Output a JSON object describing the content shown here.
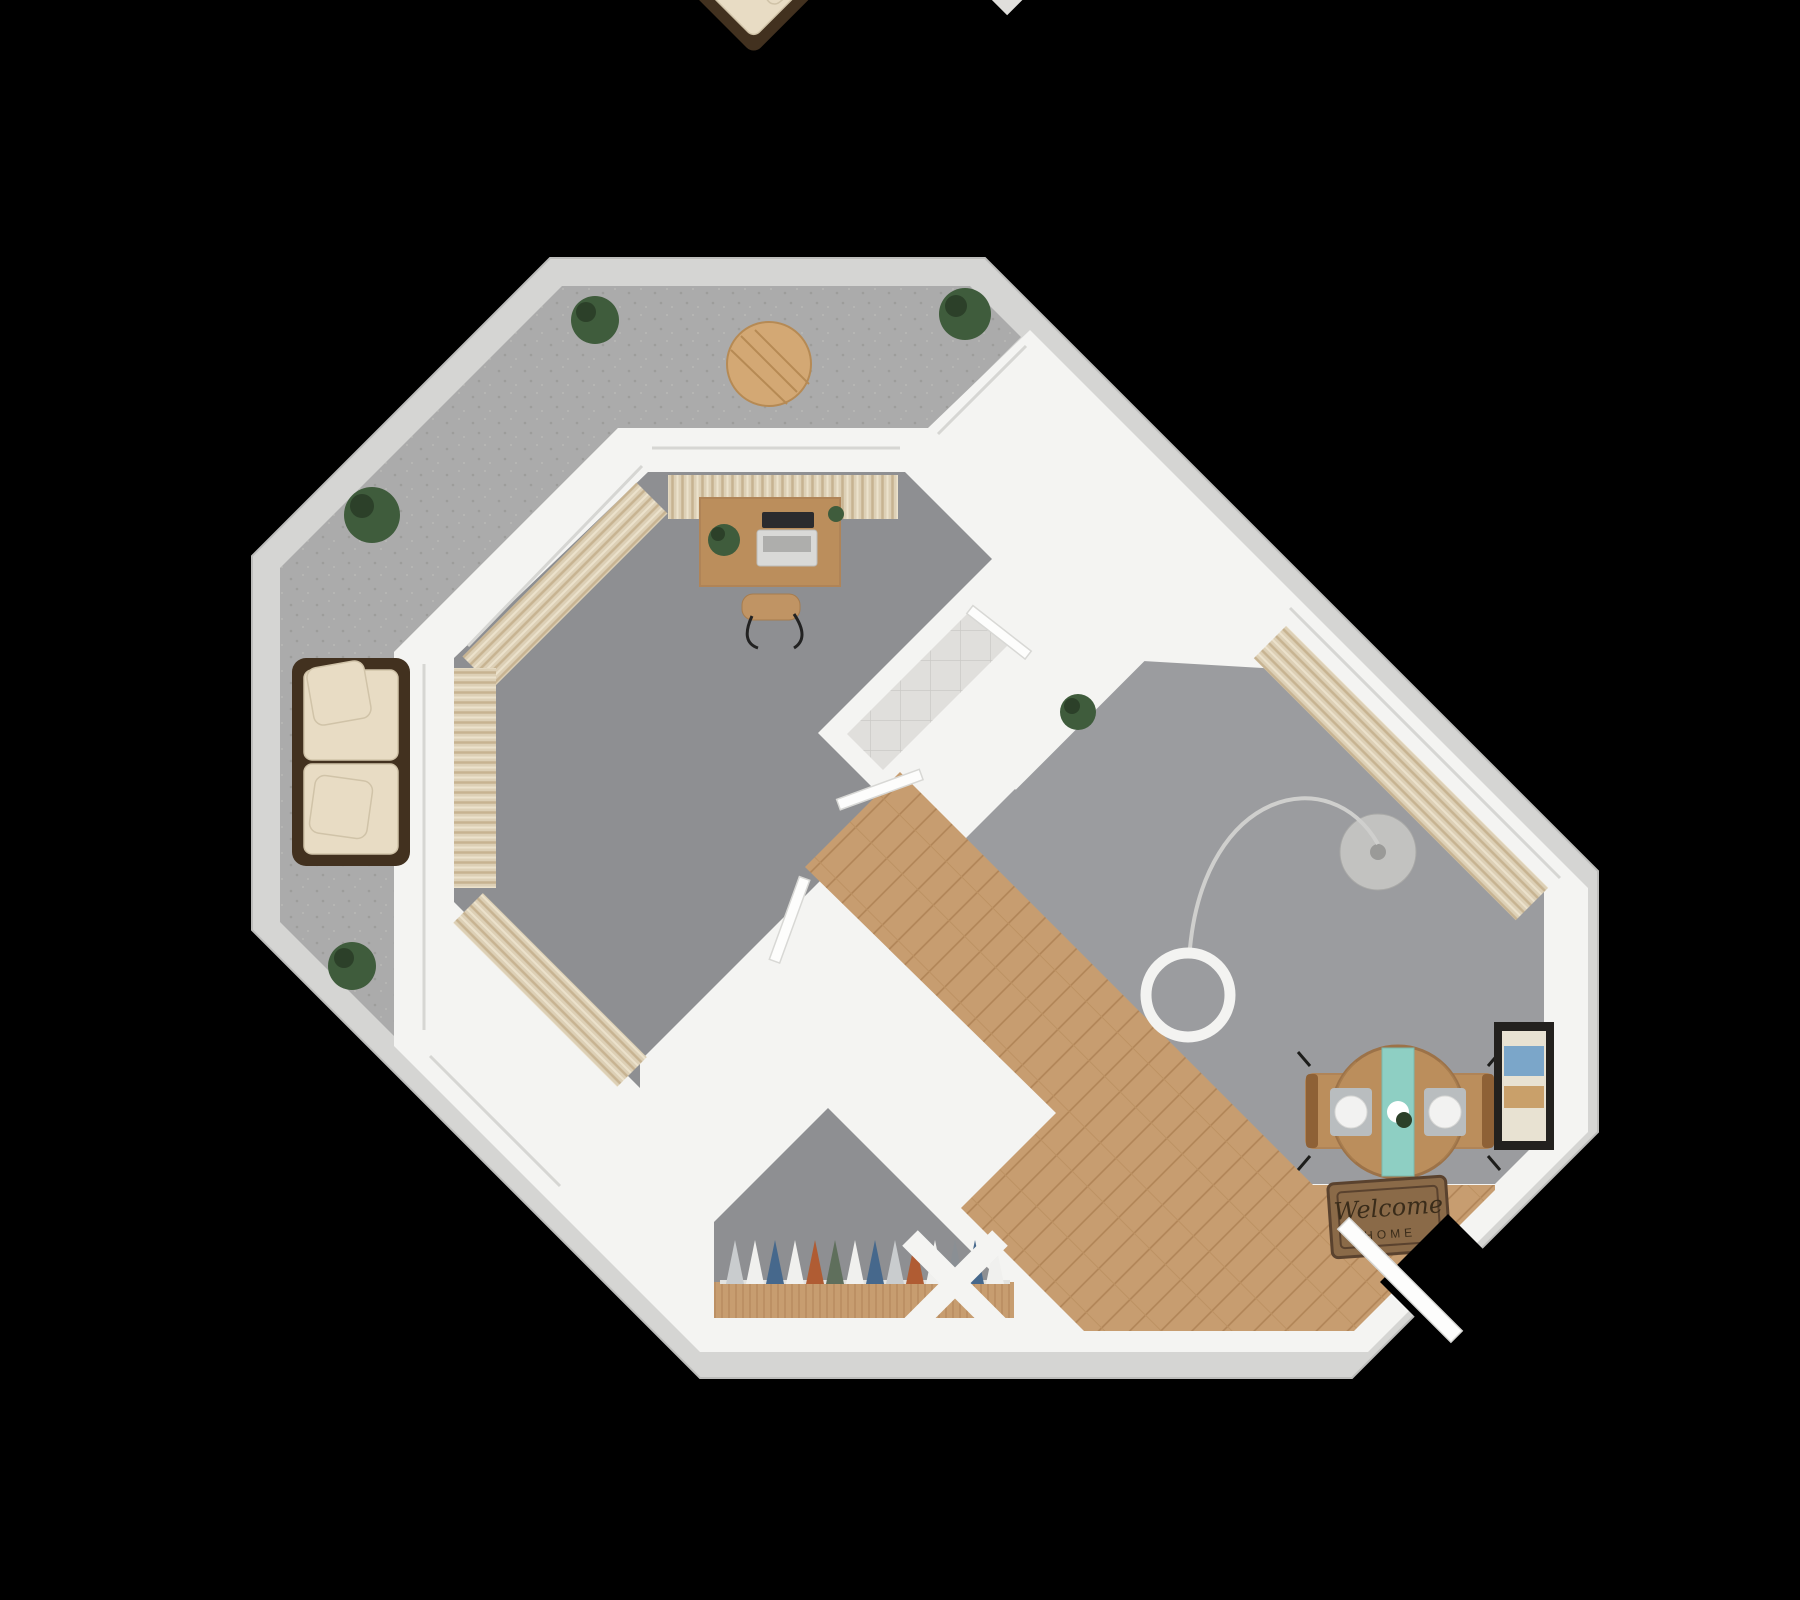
{
  "scene": {
    "kind": "3d-floor-plan-render",
    "view": "top-down",
    "background": "black",
    "orientation": "unit rotated 45 degrees with octagonal balcony wrapping top-left"
  },
  "palette": {
    "bg": "#000000",
    "band": "#d5d5d3",
    "band_edge": "#bdbdbb",
    "wall": "#f4f4f2",
    "balcony_floor": "#ababab",
    "balcony_speck": "#9d9d9b",
    "carpet_bedroom": "#8e8f92",
    "carpet_living": "#9b9c9f",
    "tile": "#e0dfdc",
    "tile_line": "#cbcac6",
    "wood": "#c79d70",
    "wood_dark": "#b08457",
    "curtain": "#ddd0b6",
    "curtain_stripe": "#c7b391",
    "glass": "#d6d6d3",
    "outdoor_frame": "#42311f",
    "outdoor_cushion": "#e8dcc4",
    "bed_frame": "#b5895c",
    "bed_blanket": "#cfbcb2",
    "bed_sheet": "#fbfaf8",
    "pillow": "#f5f3ef",
    "desk_wood": "#c09464",
    "sofa": "#e9e0c9",
    "cushion_light": "#f0e8d4",
    "rug": "#ece8de",
    "rug_line": "#c3bcaa",
    "table_wood": "#bb8e5c",
    "tv": "#303034",
    "teal": "#8ecfc3",
    "mat": "#8a6a48",
    "mat_border": "#5a422e",
    "mat_text": "#3a2c1a",
    "blue_mat": "#a9bcc4",
    "art_frame": "#23211e",
    "art_blue": "#7ba6c9",
    "art_tan": "#c9a06a",
    "plant": "#3f5c3c",
    "plant_dark": "#2c4029",
    "porcelain": "#fdfdfc",
    "porcelain_line": "#d9d9d6",
    "metal": "#9a9a98",
    "dark_appliance": "#3b3d41"
  },
  "rooms": [
    {
      "id": "balcony",
      "name": "Balcony / Patio",
      "floor": "concrete",
      "furniture": [
        "outdoor-sofa",
        "outdoor-armchair",
        "outdoor-armchair",
        "round-patio-table",
        "patio-chair x4",
        "potted-plant x4"
      ]
    },
    {
      "id": "bedroom",
      "name": "Bedroom",
      "floor": "carpet",
      "furniture": [
        "queen-bed",
        "pillows",
        "breakfast-tray",
        "desk",
        "laptop",
        "desk-chair",
        "desk-plant",
        "framed-art x2",
        "curtains"
      ]
    },
    {
      "id": "bathroom",
      "name": "Bathroom",
      "floor": "tile",
      "furniture": [
        "bathtub",
        "toilet",
        "vanity-sink",
        "towel-bar",
        "blue-bath-mat",
        "door"
      ]
    },
    {
      "id": "living",
      "name": "Living / Dining Room",
      "floor": "carpet",
      "furniture": [
        "sofa",
        "armchair",
        "throw-pillow",
        "coffee-table",
        "tablet",
        "bowl",
        "area-rug",
        "tv-console",
        "tv",
        "arc-floor-lamp",
        "curtains",
        "round-dining-table",
        "teal-table-runner",
        "place-setting x2",
        "dining-chair x2",
        "framed-art"
      ]
    },
    {
      "id": "kitchen",
      "name": "Kitchen",
      "floor": "tile",
      "furniture": [
        "sink",
        "coffee-maker",
        "toaster",
        "fruit-plate",
        "small-rug"
      ]
    },
    {
      "id": "closet",
      "name": "Closets",
      "floor": "carpet",
      "furniture": [
        "hanging-clothes",
        "wood-shelf"
      ]
    },
    {
      "id": "entry",
      "name": "Entry",
      "floor": "wood",
      "furniture": [
        "console-bookcase",
        "welcome-mat",
        "front-door"
      ]
    }
  ],
  "entry": {
    "welcome_mat": {
      "line1": "Welcome",
      "line2": "HOME"
    }
  },
  "closet": {
    "clothes_colors": [
      "#c9ccce",
      "#f0f0ee",
      "#46688c",
      "#f0f0ee",
      "#b05c33",
      "#5f6f5c",
      "#f0f0ee",
      "#46688c",
      "#c9ccce",
      "#b05c33",
      "#f0f0ee",
      "#8a8f94",
      "#46688c",
      "#f0f0ee"
    ],
    "clothes_colors_right": [
      "#46688c",
      "#f0f0ee",
      "#b05c33",
      "#c9ccce",
      "#46688c"
    ]
  }
}
